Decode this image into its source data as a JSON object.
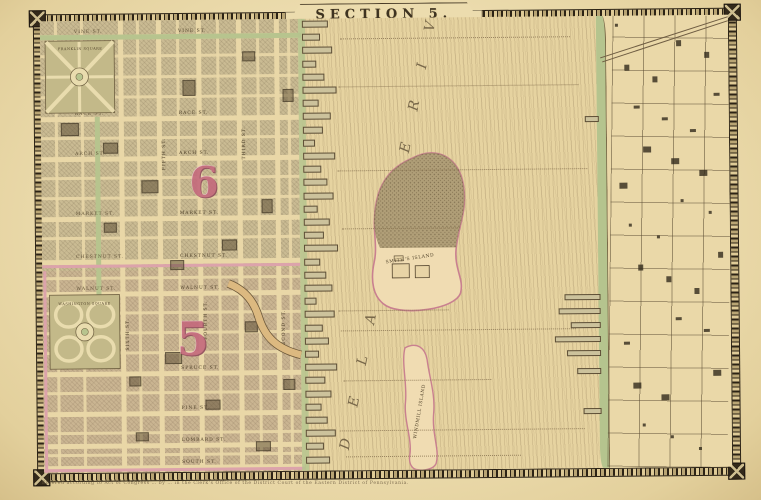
{
  "map_sheet": {
    "title": "SECTION 5.",
    "river": {
      "label": "D E L A W A R E   R I V E R"
    },
    "islands": [
      {
        "name": "SMITH'S ISLAND"
      },
      {
        "name": "WINDMILL ISLAND"
      }
    ],
    "wards": [
      {
        "number": "6"
      },
      {
        "number": "5"
      }
    ],
    "parks": [
      {
        "name": "FRANKLIN SQUARE"
      },
      {
        "name": "WASHINGTON SQUARE"
      }
    ],
    "streets": {
      "horizontal": [
        "VINE ST.",
        "RACE ST.",
        "ARCH ST.",
        "MARKET ST.",
        "CHESTNUT ST.",
        "WALNUT ST.",
        "SPRUCE ST.",
        "PINE ST.",
        "LOMBARD ST.",
        "SOUTH ST."
      ],
      "vertical": [
        "SIXTH ST.",
        "FIFTH ST.",
        "FOURTH ST.",
        "THIRD ST.",
        "SECOND ST.",
        "FRONT ST."
      ]
    },
    "imprint": "Entered according to Act of Congress … by … in the Clerk's Office of the District Court of the Eastern District of Pennsylvania.",
    "colors": {
      "paper": "#e8d6a6",
      "block": "#cabb93",
      "border_ink": "#2c2315",
      "ward_pink": "#c4697c",
      "park_green": "#b7c48e",
      "shore_green": "#b5c48e",
      "river_ink": "#85704e"
    }
  }
}
